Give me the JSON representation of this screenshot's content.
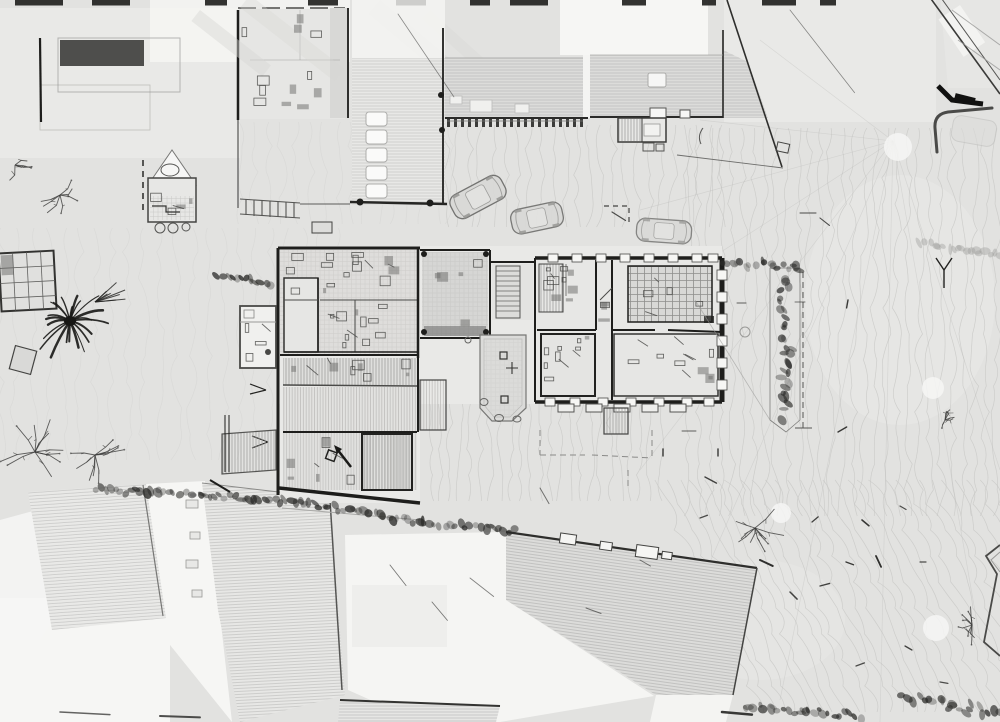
{
  "view": {
    "width": 1000,
    "height": 722,
    "kind": "laser-scan-orthographic-top-view",
    "style": "grayscale-point-cloud"
  },
  "palette": {
    "ground": "#e2e2e0",
    "ground_light": "#eaeae8",
    "nodata": "#f6f6f4",
    "floor": "#dedddb",
    "floor_dark": "#d6d6d4",
    "roof_base": "#dcdcda",
    "roof_base_light": "#e8e8e6",
    "roof_line": "#bcbcba",
    "wall_dark": "#1e1e1c",
    "wall_mid": "#4a4a48",
    "line_light": "#9a9a98",
    "contour": "#c8c8c6",
    "hedge": "#2c2c2a",
    "tree": "#3a3a38",
    "car_line": "#6e6e6c",
    "car_fill": "#d9d9d7"
  },
  "scene": {
    "buildings": [
      {
        "name": "northwest-building",
        "type": "building-with-courtyard"
      },
      {
        "name": "north-l-building",
        "type": "hatched-roof-wing"
      },
      {
        "name": "main-building",
        "type": "open-floorplan-scan"
      },
      {
        "name": "northeast-tilted-building",
        "type": "partial-corner"
      },
      {
        "name": "south-roof-row",
        "type": "hatched-roofs"
      },
      {
        "name": "southeast-large-roof",
        "type": "hatched-roof"
      }
    ],
    "cars": [
      {
        "cx": 478,
        "cy": 197,
        "angle": -28,
        "len": 57,
        "wid": 26,
        "opacity": 0.95
      },
      {
        "cx": 537,
        "cy": 218,
        "angle": -12,
        "len": 52,
        "wid": 25,
        "opacity": 0.9
      },
      {
        "cx": 664,
        "cy": 231,
        "angle": 4,
        "len": 55,
        "wid": 23,
        "opacity": 0.8
      }
    ],
    "palm": {
      "cx": 70,
      "cy": 321,
      "fronds": 22,
      "rmin": 16,
      "rmax": 40
    },
    "trees": [
      {
        "cx": 35,
        "cy": 452,
        "r": 38,
        "n": 10
      },
      {
        "cx": 95,
        "cy": 455,
        "r": 30,
        "n": 9
      },
      {
        "cx": 60,
        "cy": 195,
        "r": 26,
        "n": 7
      },
      {
        "cx": 15,
        "cy": 165,
        "r": 18,
        "n": 5
      },
      {
        "cx": 755,
        "cy": 528,
        "r": 30,
        "n": 9
      },
      {
        "cx": 945,
        "cy": 420,
        "r": 15,
        "n": 6
      },
      {
        "cx": 972,
        "cy": 625,
        "r": 20,
        "n": 8
      }
    ],
    "hedges": [
      {
        "pts": [
          [
            95,
            489
          ],
          [
            200,
            495
          ],
          [
            300,
            503
          ],
          [
            420,
            522
          ],
          [
            515,
            531
          ]
        ],
        "w": 5
      },
      {
        "pts": [
          [
            722,
            262
          ],
          [
            760,
            265
          ],
          [
            800,
            268
          ]
        ],
        "w": 7
      },
      {
        "pts": [
          [
            786,
            272
          ],
          [
            783,
            310
          ],
          [
            788,
            350
          ],
          [
            784,
            390
          ],
          [
            782,
            415
          ]
        ],
        "w": 9
      },
      {
        "pts": [
          [
            218,
            276
          ],
          [
            245,
            280
          ],
          [
            272,
            284
          ]
        ],
        "w": 5
      },
      {
        "pts": [
          [
            905,
            695
          ],
          [
            950,
            705
          ],
          [
            1000,
            714
          ]
        ],
        "w": 9
      },
      {
        "pts": [
          [
            745,
            706
          ],
          [
            800,
            712
          ],
          [
            860,
            717
          ]
        ],
        "w": 7
      },
      {
        "pts": [
          [
            920,
            243
          ],
          [
            960,
            249
          ],
          [
            1000,
            255
          ]
        ],
        "w": 4,
        "light": true
      }
    ],
    "contour_regions": [
      {
        "x0": 688,
        "x1": 1000,
        "y0": 128,
        "y1": 530,
        "step": 11,
        "amp": 5,
        "dir": "v"
      },
      {
        "x0": 430,
        "x1": 660,
        "y0": 295,
        "y1": 525,
        "step": 10,
        "amp": 4,
        "dir": "v"
      },
      {
        "x0": 445,
        "x1": 730,
        "y0": 125,
        "y1": 248,
        "step": 12,
        "amp": 5,
        "dir": "v"
      },
      {
        "x0": 655,
        "x1": 1000,
        "y0": 480,
        "y1": 722,
        "step": 12,
        "amp": 5,
        "dir": "d"
      },
      {
        "x0": 0,
        "x1": 340,
        "y0": 228,
        "y1": 478,
        "step": 16,
        "amp": 6,
        "dir": "v",
        "faint": true
      },
      {
        "x0": 240,
        "x1": 450,
        "y0": 122,
        "y1": 228,
        "step": 14,
        "amp": 5,
        "dir": "v",
        "faint": true
      }
    ],
    "scan_rays": {
      "origin": [
        893,
        141
      ],
      "targets": [
        [
          760,
          40
        ],
        [
          700,
          120
        ],
        [
          640,
          210
        ],
        [
          600,
          330
        ],
        [
          640,
          470
        ],
        [
          700,
          585
        ],
        [
          780,
          700
        ],
        [
          880,
          722
        ],
        [
          980,
          640
        ],
        [
          1000,
          470
        ]
      ]
    },
    "light_blobs": [
      {
        "cx": 898,
        "cy": 147,
        "r": 14
      },
      {
        "cx": 933,
        "cy": 388,
        "r": 11
      },
      {
        "cx": 936,
        "cy": 628,
        "r": 13
      },
      {
        "cx": 781,
        "cy": 513,
        "r": 10
      }
    ],
    "edge_dashes": [
      [
        15,
        48
      ],
      [
        92,
        38
      ],
      [
        205,
        22
      ],
      [
        308,
        30
      ],
      [
        396,
        30
      ],
      [
        470,
        20
      ],
      [
        510,
        38
      ],
      [
        622,
        24
      ],
      [
        702,
        14
      ],
      [
        762,
        34
      ],
      [
        820,
        16
      ]
    ],
    "ground_marks": [
      [
        848,
        300,
        8,
        100,
        1.4,
        0.9
      ],
      [
        838,
        432,
        10,
        -30,
        1.4,
        0.9
      ],
      [
        862,
        520,
        9,
        40,
        1.6,
        0.9
      ],
      [
        876,
        556,
        12,
        65,
        1.8,
        0.95
      ],
      [
        846,
        562,
        8,
        20,
        1.4,
        0.9
      ],
      [
        820,
        586,
        10,
        -15,
        1.4,
        0.85
      ],
      [
        900,
        506,
        7,
        30,
        1.2,
        0.8
      ],
      [
        920,
        562,
        6,
        0,
        1.2,
        0.8
      ],
      [
        812,
        522,
        8,
        -40,
        1.3,
        0.85
      ],
      [
        795,
        302,
        10,
        0,
        1,
        0.6
      ],
      [
        737,
        303,
        9,
        0,
        1,
        0.7
      ],
      [
        760,
        560,
        14,
        25,
        2,
        0.95
      ],
      [
        790,
        592,
        10,
        45,
        1.5,
        0.85
      ],
      [
        700,
        518,
        8,
        -20,
        1.3,
        0.8
      ],
      [
        718,
        449,
        7,
        90,
        1.4,
        0.9
      ],
      [
        663,
        449,
        7,
        90,
        1.4,
        0.9
      ],
      [
        682,
        431,
        14,
        0,
        0.9,
        0.7
      ],
      [
        905,
        646,
        8,
        30,
        1.3,
        0.85
      ],
      [
        856,
        666,
        9,
        -20,
        1.3,
        0.8
      ],
      [
        940,
        682,
        8,
        10,
        1.3,
        0.8
      ],
      [
        398,
        14,
        100,
        56,
        0.8,
        0.5
      ],
      [
        790,
        10,
        105,
        52,
        0.8,
        0.5
      ],
      [
        612,
        212,
        16,
        32,
        1.2,
        0.8
      ],
      [
        800,
        213,
        16,
        0,
        1.1,
        0.8
      ],
      [
        820,
        218,
        12,
        38,
        1.1,
        0.8
      ],
      [
        390,
        565,
        26,
        52,
        0.9,
        0.6
      ],
      [
        432,
        602,
        24,
        50,
        0.9,
        0.6
      ],
      [
        470,
        578,
        30,
        38,
        0.9,
        0.55
      ],
      [
        540,
        488,
        18,
        60,
        1,
        0.6
      ],
      [
        586,
        608,
        16,
        20,
        1,
        0.6
      ],
      [
        640,
        560,
        12,
        30,
        1,
        0.6
      ],
      [
        705,
        477,
        13,
        28,
        1.4,
        0.85
      ],
      [
        722,
        712,
        30,
        5,
        2.5,
        0.9
      ],
      [
        160,
        716,
        40,
        2,
        2,
        0.8
      ],
      [
        60,
        712,
        50,
        3,
        1.5,
        0.7
      ]
    ],
    "furniture_zones": [
      [
        286,
        252,
        128,
        44,
        16
      ],
      [
        322,
        302,
        92,
        48,
        12
      ],
      [
        286,
        357,
        128,
        26,
        10
      ],
      [
        424,
        254,
        60,
        78,
        5
      ],
      [
        541,
        266,
        52,
        44,
        10
      ],
      [
        598,
        264,
        12,
        62,
        4
      ],
      [
        541,
        334,
        52,
        60,
        10
      ],
      [
        616,
        334,
        100,
        60,
        12
      ],
      [
        630,
        268,
        80,
        52,
        5
      ],
      [
        240,
        310,
        34,
        54,
        4
      ],
      [
        284,
        434,
        76,
        52,
        8
      ],
      [
        240,
        12,
        100,
        100,
        12
      ],
      [
        150,
        180,
        44,
        40,
        5
      ]
    ],
    "survey_tripod": {
      "cx": 944,
      "cy": 270
    }
  }
}
